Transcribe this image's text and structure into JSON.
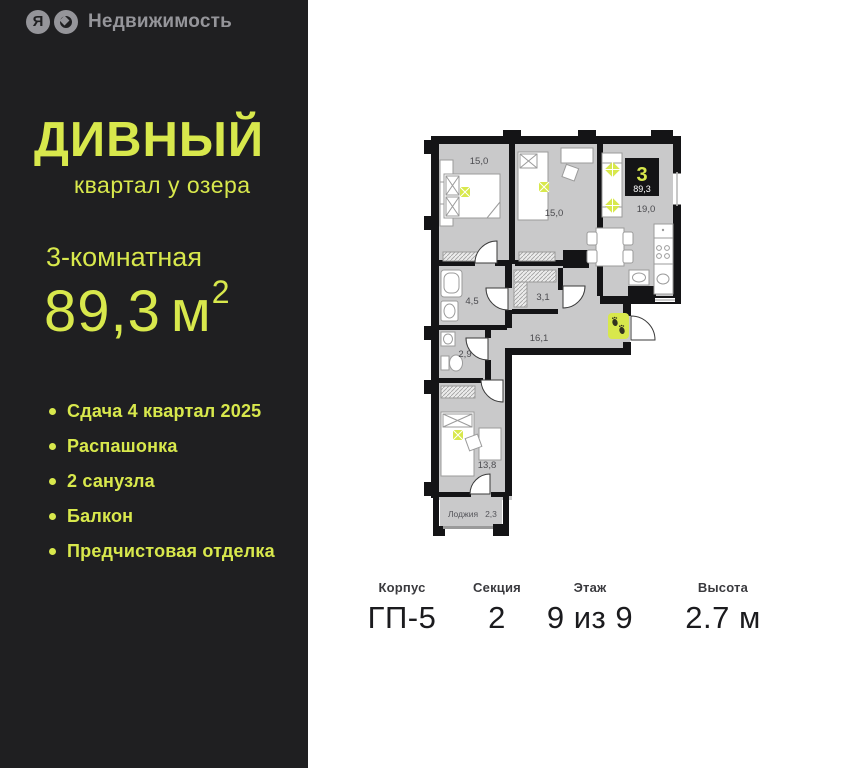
{
  "brand": {
    "ya_letter": "Я",
    "name": "Недвижимость"
  },
  "project": {
    "name": "ДИВНЫЙ",
    "tagline": "квартал у озера"
  },
  "listing": {
    "type": "3-комнатная",
    "area_value": "89,3",
    "area_unit": "м",
    "area_power": "2"
  },
  "features": [
    "Сдача 4 квартал 2025",
    "Распашонка",
    "2 санузла",
    "Балкон",
    "Предчистовая отделка"
  ],
  "plan": {
    "badge": {
      "rooms": "3",
      "area": "89,3"
    },
    "labels": {
      "bedroom1": "15,0",
      "bedroom2": "15,0",
      "living": "19,0",
      "bathroom": "4,5",
      "corridor": "3,1",
      "wc": "2,9",
      "hall": "16,1",
      "bedroom3": "13,8",
      "loggia": "Лоджия",
      "loggia_area": "2,3"
    }
  },
  "info": [
    {
      "label": "Корпус",
      "value": "ГП-5"
    },
    {
      "label": "Секция",
      "value": "2"
    },
    {
      "label": "Этаж",
      "value": "9 из 9"
    },
    {
      "label": "Высота",
      "value": "2.7 м"
    }
  ],
  "colors": {
    "accent": "#d8e84c",
    "panel_bg": "#1f1f21",
    "floor": "#c9c9ca",
    "wall": "#141416"
  }
}
